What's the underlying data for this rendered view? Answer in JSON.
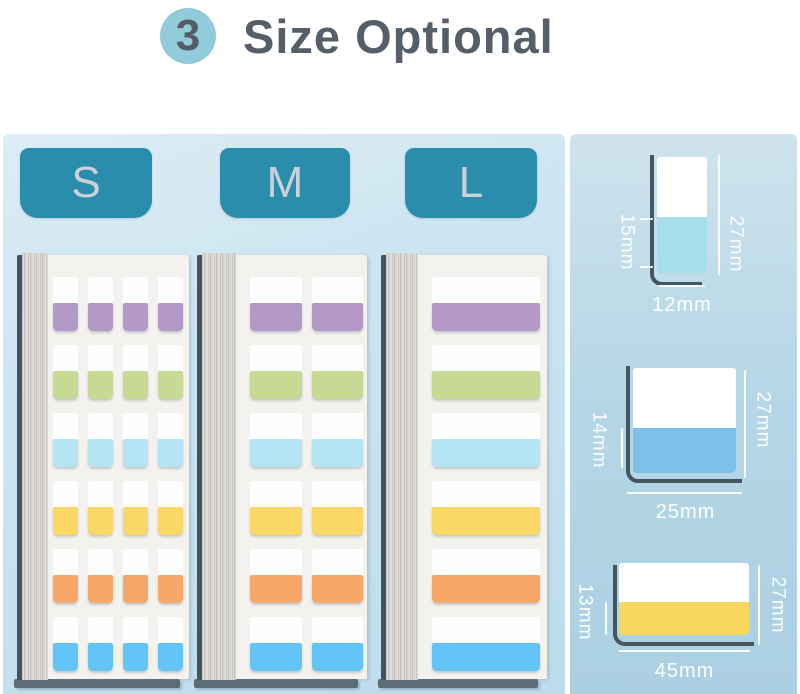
{
  "header": {
    "badge": "3",
    "title": "Size Optional"
  },
  "panel": {
    "sizes": [
      {
        "label": "S",
        "columns": 4
      },
      {
        "label": "M",
        "columns": 2
      },
      {
        "label": "L",
        "columns": 1
      }
    ]
  },
  "tab_colors": [
    {
      "name": "purple",
      "hex": "#b499c8"
    },
    {
      "name": "green",
      "hex": "#c8d994"
    },
    {
      "name": "cyan",
      "hex": "#b5e5f3"
    },
    {
      "name": "yellow",
      "hex": "#fbd765"
    },
    {
      "name": "orange",
      "hex": "#f6a76a"
    },
    {
      "name": "blue",
      "hex": "#62c5f5"
    }
  ],
  "diagrams": [
    {
      "size": "S",
      "total_height": "27mm",
      "tab_height": "15mm",
      "width": "12mm",
      "fill": "#a5dfeb"
    },
    {
      "size": "M",
      "total_height": "27mm",
      "tab_height": "14mm",
      "width": "25mm",
      "fill": "#7fc0e9"
    },
    {
      "size": "L",
      "total_height": "27mm",
      "tab_height": "13mm",
      "width": "45mm",
      "fill": "#f8d75f"
    }
  ],
  "colors": {
    "size_tab_bg": "#2a8dac",
    "badge_bg": "#92cbd9",
    "outline_dark": "#45565f"
  }
}
